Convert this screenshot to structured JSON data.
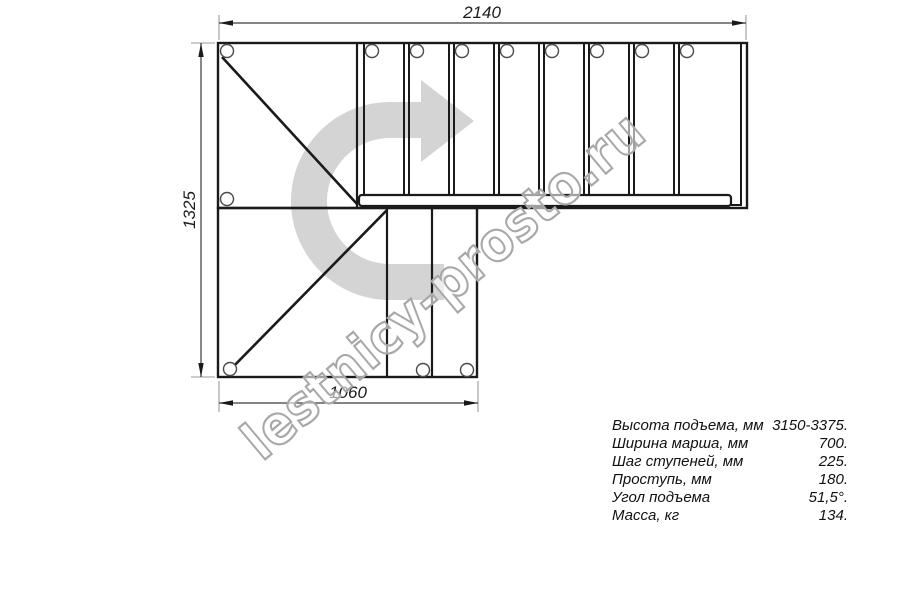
{
  "drawing": {
    "title": "L-shaped staircase plan view",
    "dimensions": {
      "top_width_mm": "2140",
      "left_height_mm": "1325",
      "bottom_width_mm": "1060"
    },
    "watermark": "lestnicy-prosto.ru",
    "direction_arrow": "up-and-turn-right",
    "colors": {
      "line": "#1a1a1a",
      "dimension_line": "#3a3a3a",
      "extension_line": "#9a9a9a",
      "arrow_fill": "#d4d4d4",
      "watermark_stroke": "#a8a8a8"
    }
  },
  "specs": {
    "rows": [
      {
        "label": "Высота подъема, мм",
        "value": "3150-3375."
      },
      {
        "label": "Ширина марша, мм",
        "value": "700."
      },
      {
        "label": "Шаг ступеней, мм",
        "value": "225."
      },
      {
        "label": "Проступь, мм",
        "value": "180."
      },
      {
        "label": "Угол подъема",
        "value": "51,5°."
      },
      {
        "label": "Масса, кг",
        "value": "134."
      }
    ]
  }
}
